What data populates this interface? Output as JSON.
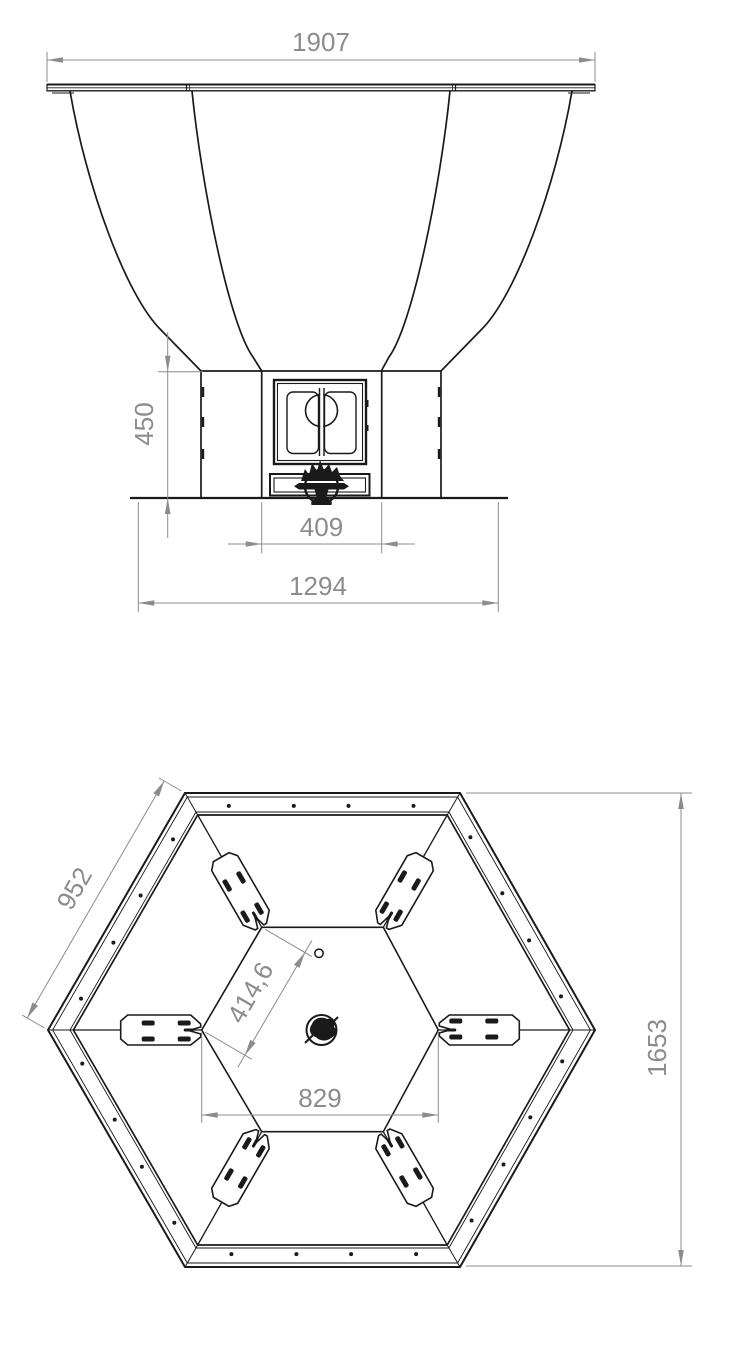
{
  "document": {
    "type": "technical-drawing",
    "subject": "hexagonal fire bowl with pedestal base - front elevation and bottom plan view"
  },
  "front_view": {
    "dim_rim_width": "1907",
    "dim_base_height": "450",
    "dim_door_width": "409",
    "dim_base_width": "1294"
  },
  "plan_view": {
    "dim_outer_edge": "952",
    "dim_inner_edge": "414,6",
    "dim_inner_width": "829",
    "dim_across_flats": "1653"
  },
  "colors": {
    "line": "#1a1a1a",
    "dimension": "#8c8c8c",
    "background": "#ffffff"
  }
}
